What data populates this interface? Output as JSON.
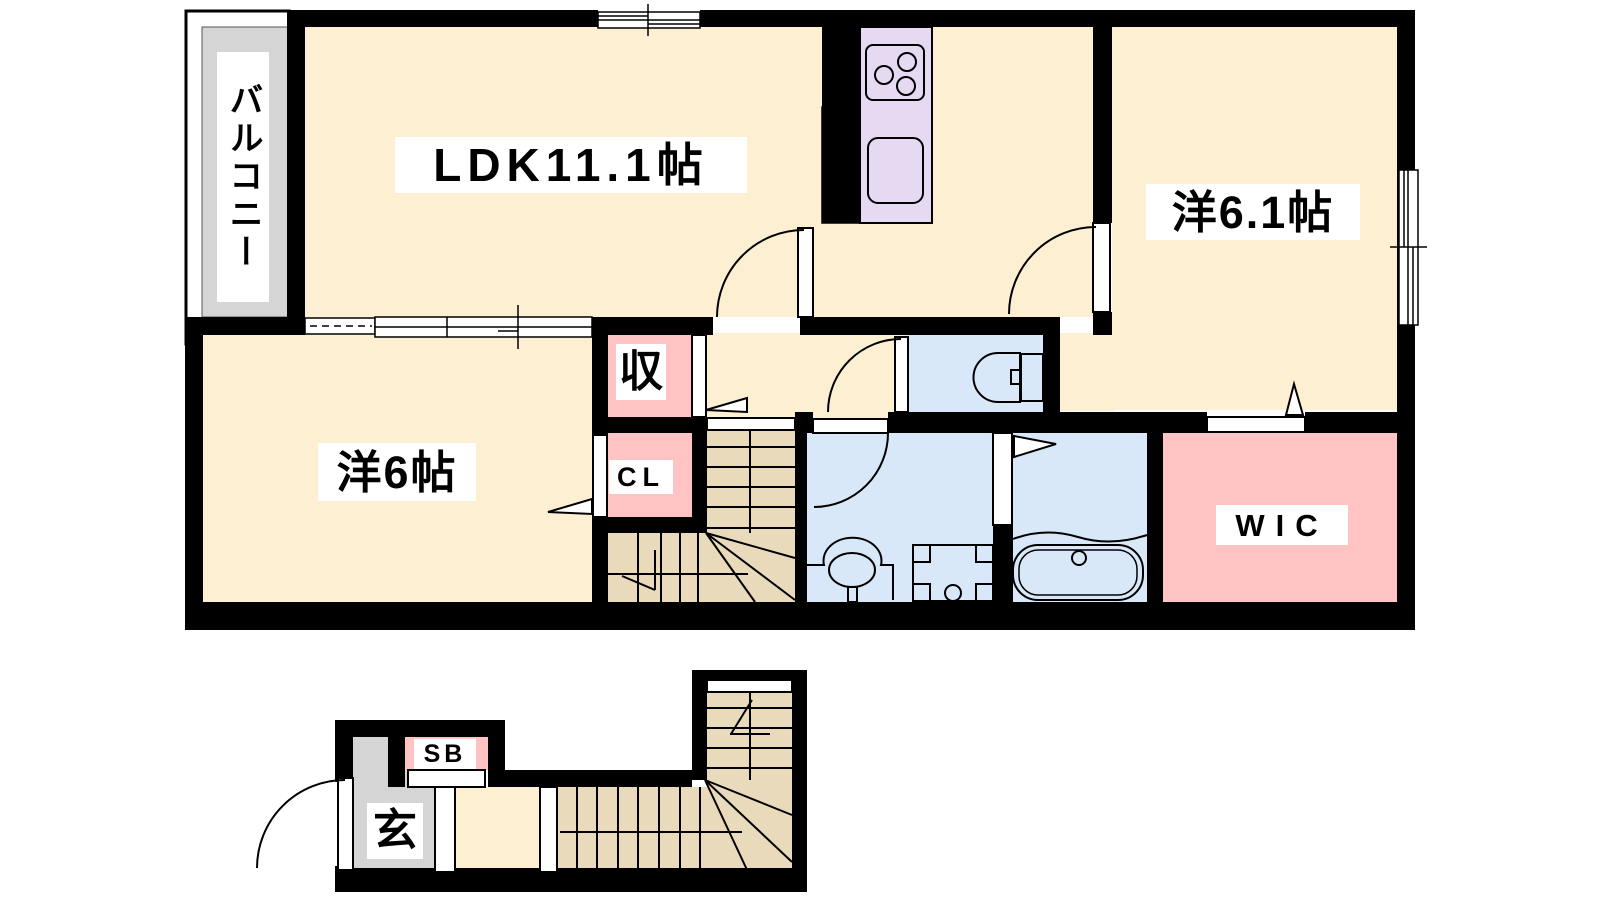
{
  "title": "apartment-floor-plan",
  "rooms": {
    "balcony": "バルコニー",
    "ldk": "LDK11.1帖",
    "bedroom1": "洋6.1帖",
    "bedroom2": "洋6帖",
    "storage": "収",
    "closet": "CL",
    "wic": "WIC",
    "shoebox": "SB",
    "entrance": "玄"
  },
  "palette": {
    "wall": "#000000",
    "floor_cream": "#fdf0d2",
    "floor_tan": "#e9dabb",
    "floor_gray": "#d5d5d5",
    "floor_pink": "#ffc3c3",
    "floor_blue": "#d9e8f8",
    "kitchen_lavender": "#e6daf2",
    "cabinet_tan": "#e3d3b0",
    "background": "#ffffff"
  }
}
